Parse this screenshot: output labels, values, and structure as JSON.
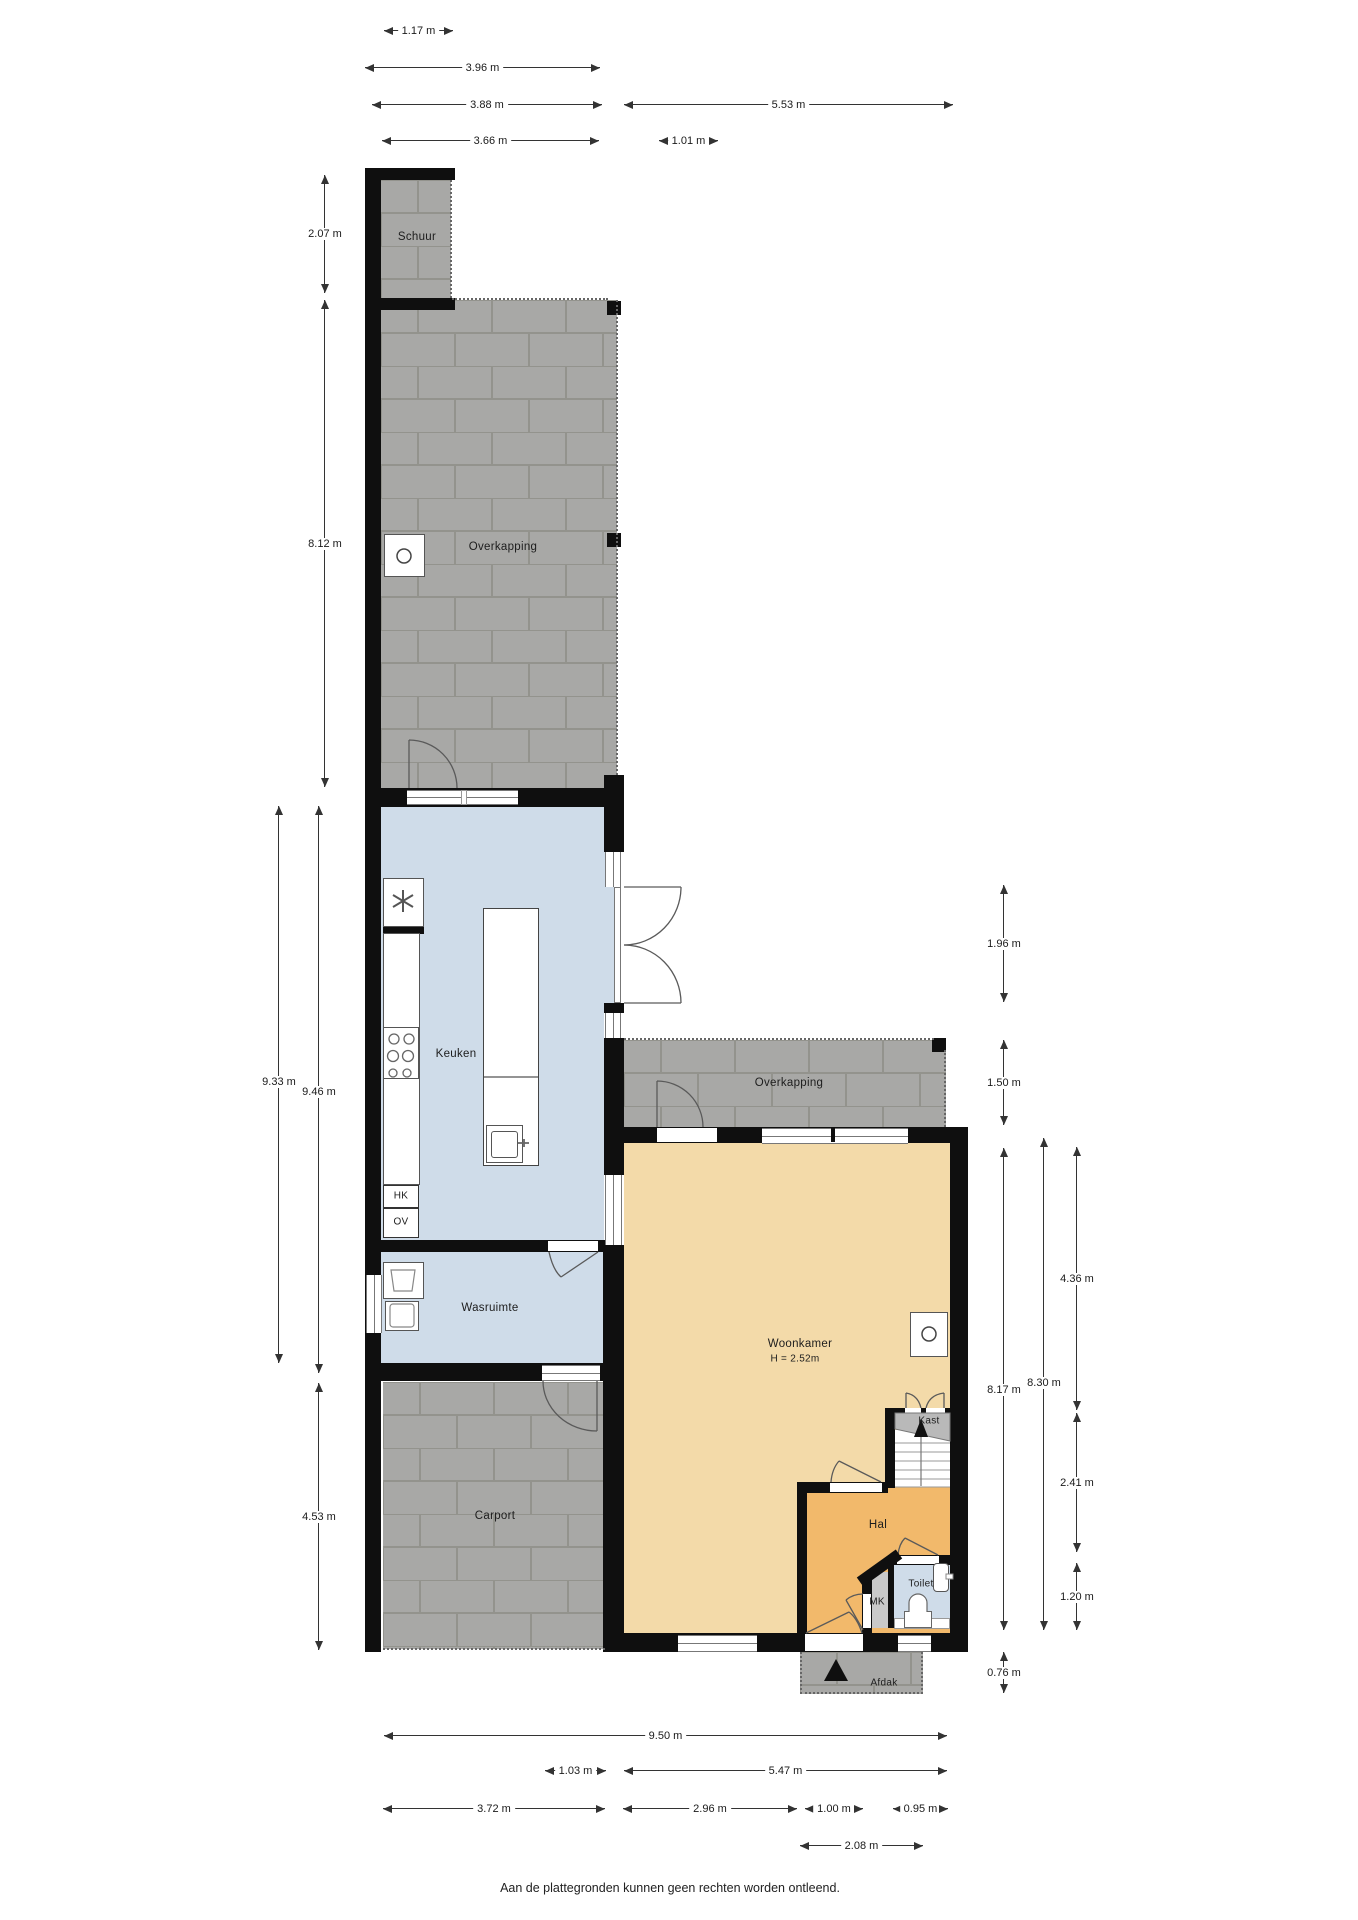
{
  "page": {
    "footer": "Aan de plattegronden kunnen geen rechten worden ontleend."
  },
  "rooms": {
    "schuur": {
      "label": "Schuur"
    },
    "overkapping_top": {
      "label": "Overkapping"
    },
    "overkapping_right": {
      "label": "Overkapping"
    },
    "keuken": {
      "label": "Keuken"
    },
    "wasruimte": {
      "label": "Wasruimte"
    },
    "carport": {
      "label": "Carport"
    },
    "woonkamer": {
      "label": "Woonkamer",
      "note": "H = 2.52m"
    },
    "hal": {
      "label": "Hal"
    },
    "toilet": {
      "label": "Toilet"
    },
    "mk": {
      "label": "MK"
    },
    "kast": {
      "label": "Kast"
    },
    "hk": {
      "label": "HK"
    },
    "ov": {
      "label": "OV"
    },
    "afdak": {
      "label": "Afdak"
    }
  },
  "dimensions": {
    "top": [
      "1.17 m",
      "3.96 m",
      "3.88 m",
      "5.53 m",
      "3.66 m",
      "1.01 m"
    ],
    "left": [
      "2.07 m",
      "8.12 m",
      "9.33 m",
      "9.46 m",
      "4.53 m"
    ],
    "right": [
      "1.96 m",
      "1.50 m",
      "8.30 m",
      "8.17 m",
      "4.36 m",
      "2.41 m",
      "1.20 m",
      "0.76 m"
    ],
    "bottom": [
      "9.50 m",
      "1.03 m",
      "5.47 m",
      "3.72 m",
      "2.96 m",
      "1.00 m",
      "0.95 m",
      "2.08 m"
    ]
  },
  "icons": {
    "boiler": "circle",
    "stove_flue": "circle",
    "mechanical_ventilation": "fan-star",
    "entrance_marker": "triangle-up",
    "stairs_direction": "arrow-up"
  },
  "colors": {
    "wall": "#0f0f0f",
    "wet_room_floor": "#cfdce9",
    "living_floor": "#f3daa9",
    "hall_floor": "#f2b96b",
    "paving_tile": "#a8a8a6",
    "paving_joint": "#93938d",
    "closet": "#b9b9b9",
    "meter_cupboard": "#c9c9c9",
    "dimension_line": "#333333"
  }
}
